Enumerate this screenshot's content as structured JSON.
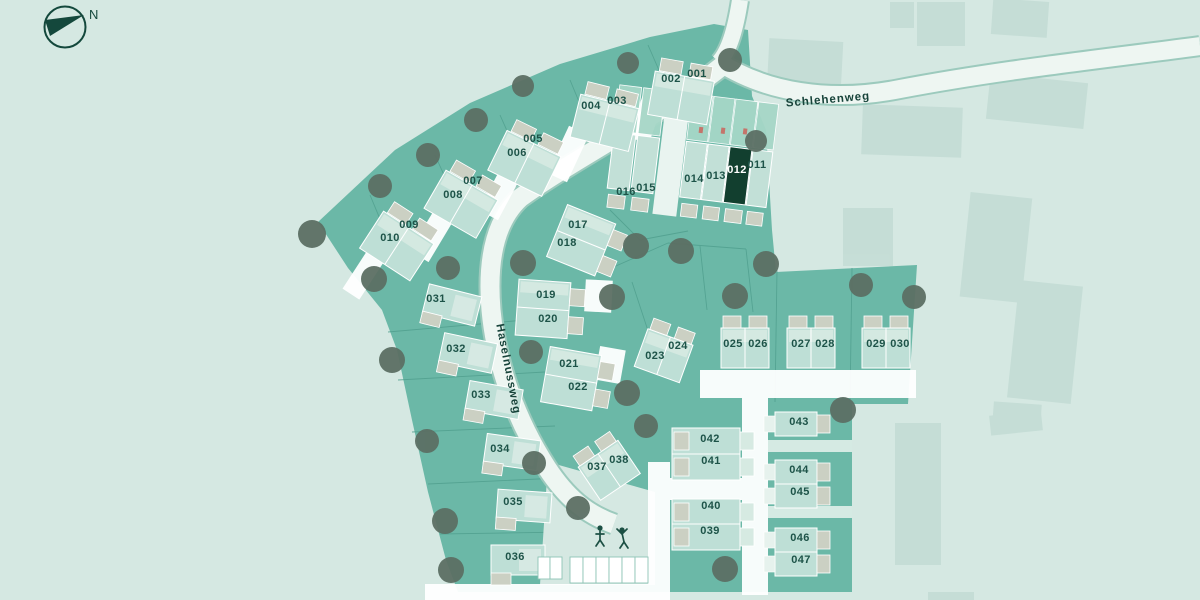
{
  "compass": {
    "label": "N"
  },
  "streets": [
    {
      "name": "Schlehenweg"
    },
    {
      "name": "Haselnussweg"
    }
  ],
  "selected_plot": "012",
  "playground": {
    "icon": "playground-figures-icon"
  },
  "colors": {
    "background": "#d5e8e2",
    "parcel_teal": "#6bb8a7",
    "selected_plot": "#123f2f",
    "house_body": "#bedfd6",
    "house_roof": "#d6eae2",
    "garage_beige": "#cbd0c3",
    "road": "#eef6f2",
    "tree": "#5c6f64",
    "label_text": "#1d5348"
  },
  "plots": [
    {
      "id": "001",
      "x": 697,
      "y": 77
    },
    {
      "id": "002",
      "x": 671,
      "y": 82
    },
    {
      "id": "003",
      "x": 617,
      "y": 104
    },
    {
      "id": "004",
      "x": 591,
      "y": 109
    },
    {
      "id": "005",
      "x": 533,
      "y": 142
    },
    {
      "id": "006",
      "x": 517,
      "y": 156
    },
    {
      "id": "007",
      "x": 473,
      "y": 184
    },
    {
      "id": "008",
      "x": 453,
      "y": 198
    },
    {
      "id": "009",
      "x": 409,
      "y": 228
    },
    {
      "id": "010",
      "x": 390,
      "y": 241
    },
    {
      "id": "011",
      "x": 757,
      "y": 168
    },
    {
      "id": "012",
      "x": 737,
      "y": 173,
      "selected": true
    },
    {
      "id": "013",
      "x": 716,
      "y": 179
    },
    {
      "id": "014",
      "x": 694,
      "y": 182
    },
    {
      "id": "015",
      "x": 646,
      "y": 191
    },
    {
      "id": "016",
      "x": 626,
      "y": 195
    },
    {
      "id": "017",
      "x": 578,
      "y": 228
    },
    {
      "id": "018",
      "x": 567,
      "y": 246
    },
    {
      "id": "019",
      "x": 546,
      "y": 298
    },
    {
      "id": "020",
      "x": 548,
      "y": 322
    },
    {
      "id": "021",
      "x": 569,
      "y": 367
    },
    {
      "id": "022",
      "x": 578,
      "y": 390
    },
    {
      "id": "023",
      "x": 655,
      "y": 359
    },
    {
      "id": "024",
      "x": 678,
      "y": 349
    },
    {
      "id": "025",
      "x": 733,
      "y": 347
    },
    {
      "id": "026",
      "x": 758,
      "y": 347
    },
    {
      "id": "027",
      "x": 801,
      "y": 347
    },
    {
      "id": "028",
      "x": 825,
      "y": 347
    },
    {
      "id": "029",
      "x": 876,
      "y": 347
    },
    {
      "id": "030",
      "x": 900,
      "y": 347
    },
    {
      "id": "031",
      "x": 436,
      "y": 302
    },
    {
      "id": "032",
      "x": 456,
      "y": 352
    },
    {
      "id": "033",
      "x": 481,
      "y": 398
    },
    {
      "id": "034",
      "x": 500,
      "y": 452
    },
    {
      "id": "035",
      "x": 513,
      "y": 505
    },
    {
      "id": "036",
      "x": 515,
      "y": 560
    },
    {
      "id": "037",
      "x": 597,
      "y": 470
    },
    {
      "id": "038",
      "x": 619,
      "y": 463
    },
    {
      "id": "039",
      "x": 710,
      "y": 534
    },
    {
      "id": "040",
      "x": 711,
      "y": 509
    },
    {
      "id": "041",
      "x": 711,
      "y": 464
    },
    {
      "id": "042",
      "x": 710,
      "y": 442
    },
    {
      "id": "043",
      "x": 799,
      "y": 425
    },
    {
      "id": "044",
      "x": 799,
      "y": 473
    },
    {
      "id": "045",
      "x": 800,
      "y": 495
    },
    {
      "id": "046",
      "x": 800,
      "y": 541
    },
    {
      "id": "047",
      "x": 801,
      "y": 563
    }
  ]
}
